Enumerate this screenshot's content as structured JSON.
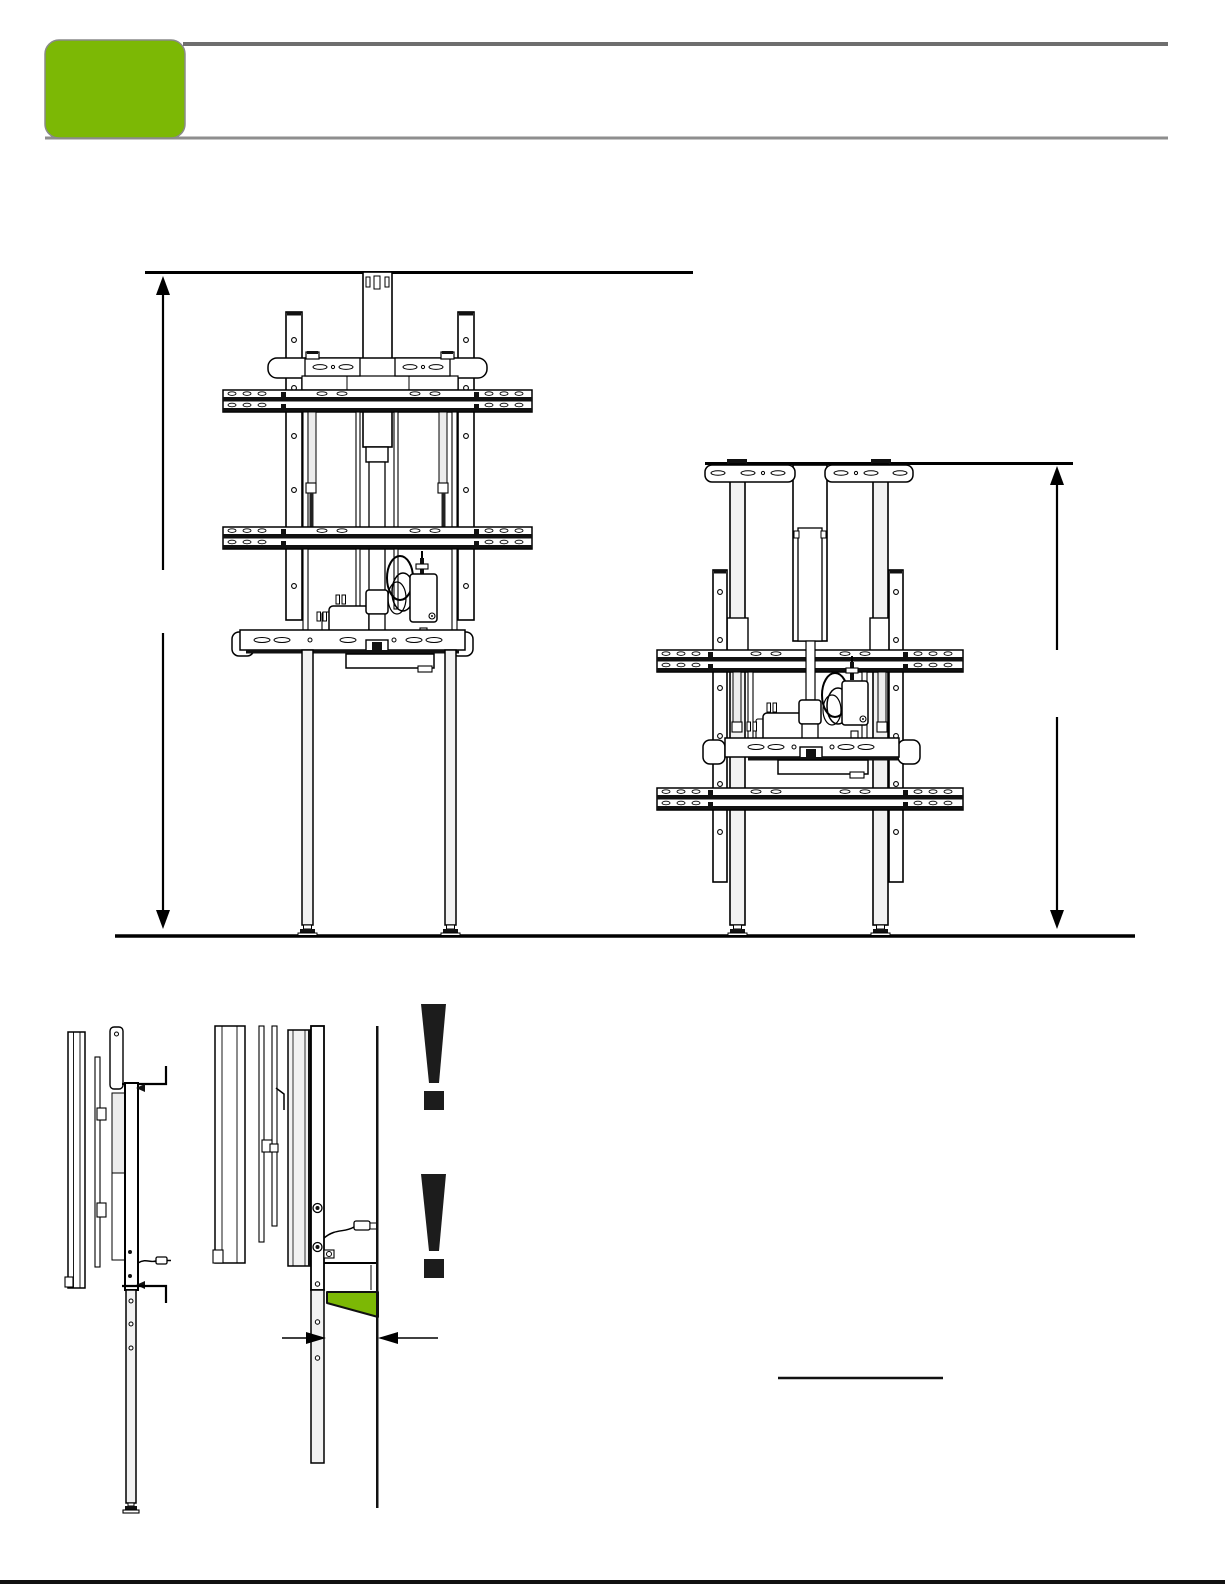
{
  "page": {
    "kind": "installation-manual-page",
    "background": "#FFFFFF"
  },
  "header": {
    "accent_tab_label": "",
    "rule_color": "#6E6E6E",
    "rule_color_light": "#8E8E8E"
  },
  "colors": {
    "accent_green": "#7CB805",
    "ink": "#000000",
    "warning_black": "#1C1C1C",
    "metal_light": "#F2F2F2",
    "metal_lighter": "#ECECEC",
    "page_border_black": "#111111"
  },
  "figures": [
    {
      "id": "front-view-raised",
      "dimension_label": ""
    },
    {
      "id": "front-view-lowered",
      "dimension_label": ""
    },
    {
      "id": "side-view-full-height"
    },
    {
      "id": "side-view-wall-gap-detail",
      "gap_dimension_label": ""
    }
  ],
  "icons": [
    {
      "name": "warning-exclamation-icon"
    },
    {
      "name": "warning-exclamation-icon"
    }
  ]
}
